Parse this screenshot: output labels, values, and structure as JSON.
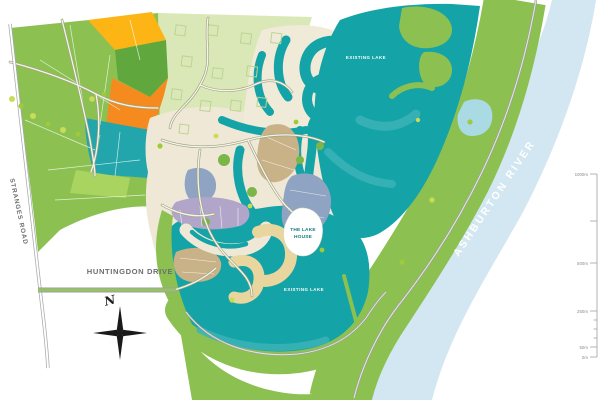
{
  "map": {
    "title": "Lake development master plan",
    "labels": {
      "stranges_road": "STRANGES ROAD",
      "huntingdon_drive": "HUNTINGDON DRIVE",
      "ashburton_river": "ASHBURTON RIVER",
      "north_lake": "EXISTING LAKE",
      "south_lake": "EXISTING LAKE",
      "lake_house_line1": "THE LAKE",
      "lake_house_line2": "HOUSE",
      "compass_north": "N"
    },
    "scale_bar": {
      "labels": [
        "1000m",
        "500m",
        "250m",
        "50m",
        "0m"
      ]
    },
    "colors": {
      "lake_teal": "#14a3a6",
      "light_teal": "#3bb3b7",
      "pale_green": "#d9e8b6",
      "mid_green": "#8cc152",
      "bright_green": "#7ab648",
      "dark_green": "#60a83e",
      "yellow_block": "#fdb515",
      "orange_block": "#f58b1f",
      "cream_lots": "#efe8d6",
      "tan_lots": "#c9b288",
      "bluegray_lots": "#8fa3c2",
      "purple_lots": "#b2a5ca",
      "khaki_lots": "#e8d69e",
      "river_blue": "#d2e7f1",
      "road_gray": "#a7a9ac",
      "label_gray": "#6d6e71"
    }
  }
}
